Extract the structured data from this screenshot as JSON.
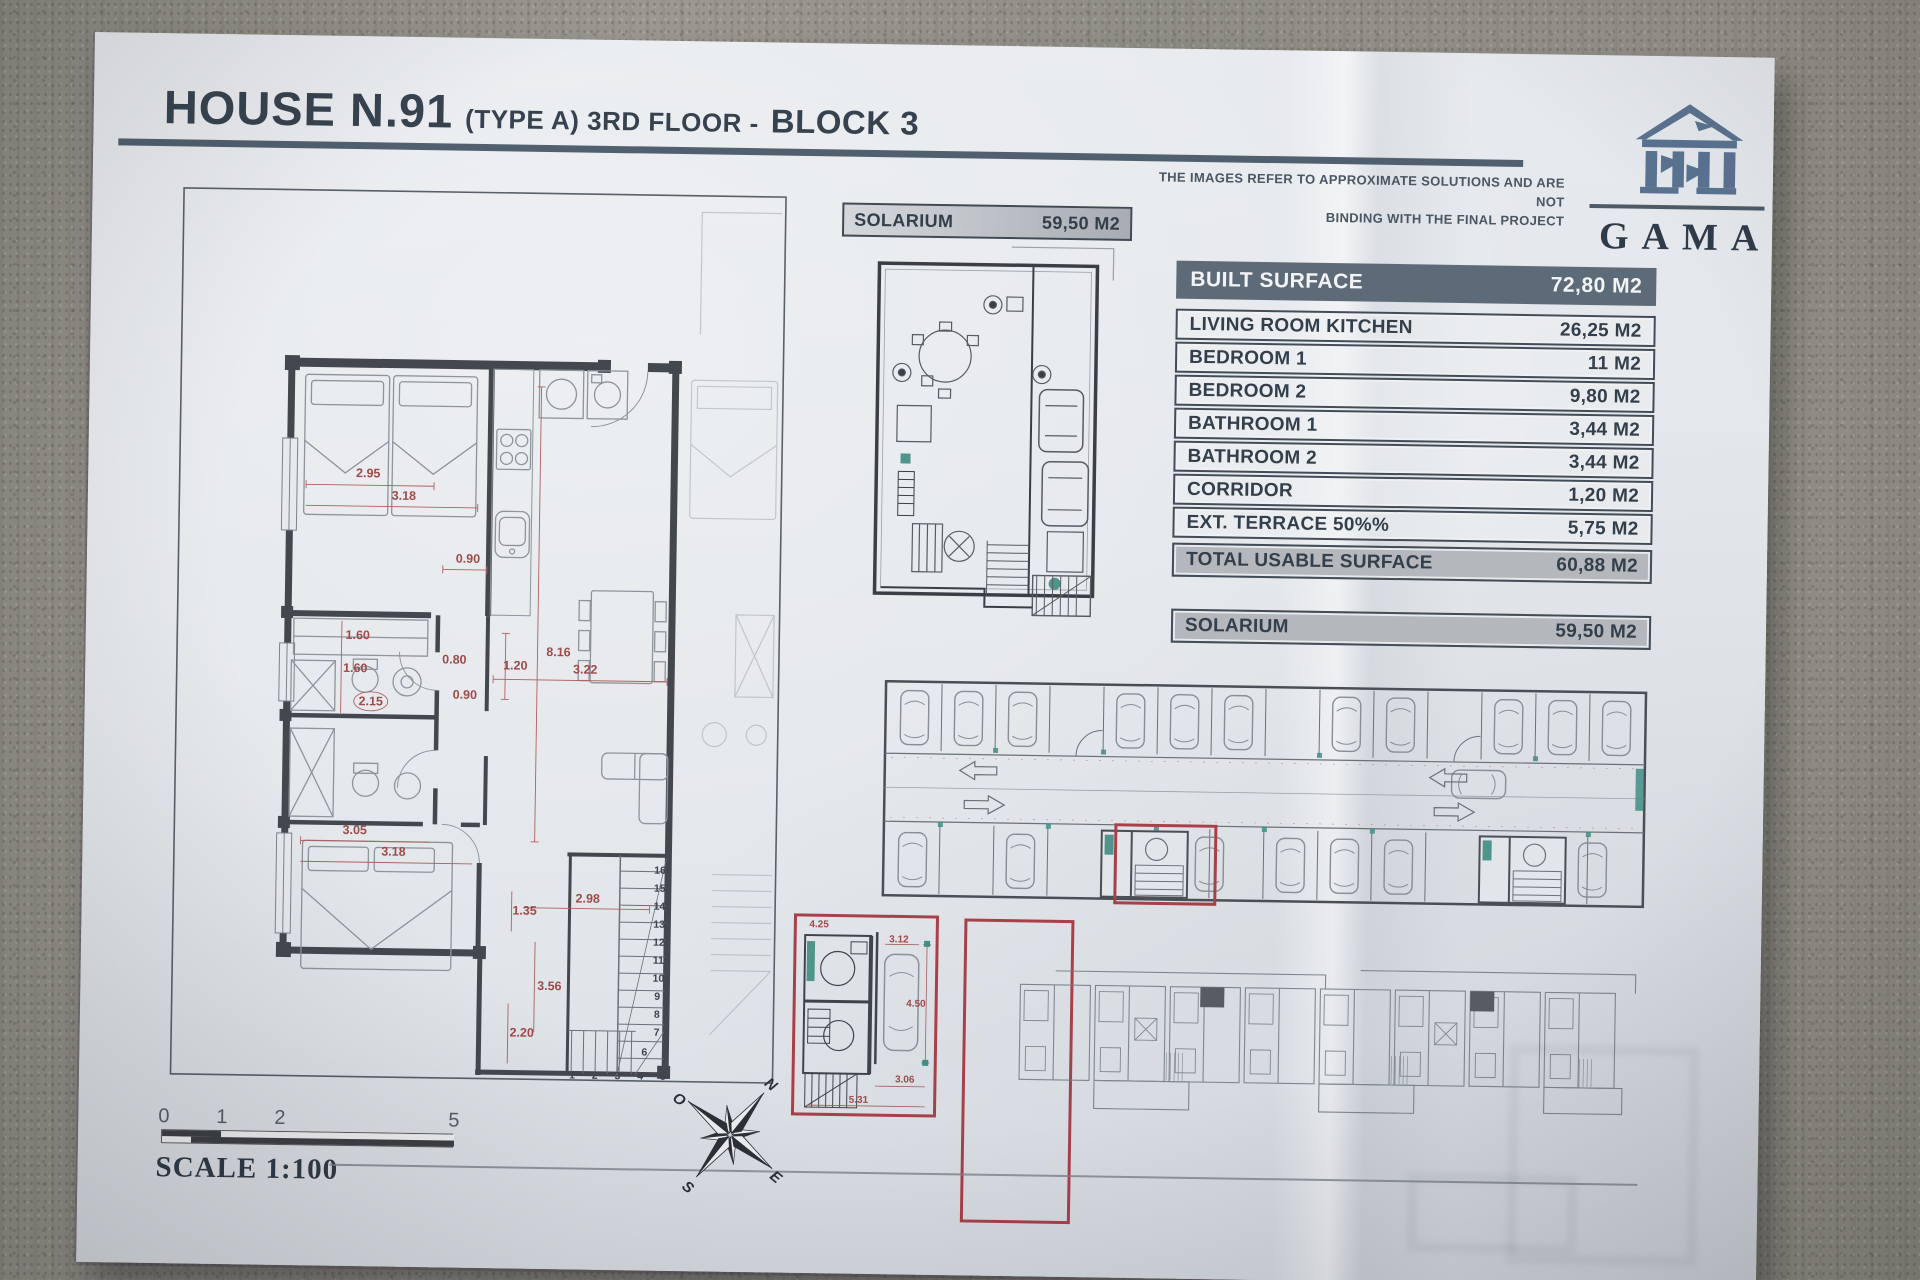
{
  "title": {
    "house": "HOUSE N.91",
    "type_floor": "(TYPE A) 3RD FLOOR -",
    "block": "BLOCK 3"
  },
  "disclaimer": {
    "line1": "THE IMAGES REFER TO APPROXIMATE SOLUTIONS AND ARE NOT",
    "line2": "BINDING WITH THE FINAL PROJECT"
  },
  "logo": {
    "name": "GAMA"
  },
  "surface_table": {
    "header": {
      "label": "BUILT SURFACE",
      "value": "72,80 M2"
    },
    "rows": [
      {
        "label": "LIVING ROOM KITCHEN",
        "value": "26,25 M2"
      },
      {
        "label": "BEDROOM 1",
        "value": "11 M2"
      },
      {
        "label": "BEDROOM 2",
        "value": "9,80 M2"
      },
      {
        "label": "BATHROOM 1",
        "value": "3,44 M2"
      },
      {
        "label": "BATHROOM 2",
        "value": "3,44 M2"
      },
      {
        "label": "CORRIDOR",
        "value": "1,20 M2"
      },
      {
        "label": "EXT. TERRACE 50%%",
        "value": "5,75 M2"
      }
    ],
    "total": {
      "label": "TOTAL USABLE SURFACE",
      "value": "60,88 M2"
    },
    "solarium": {
      "label": "SOLARIUM",
      "value": "59,50 M2"
    }
  },
  "solarium_plan": {
    "label": "SOLARIUM",
    "value": "59,50 M2"
  },
  "main_plan": {
    "dims": [
      "2.95",
      "3.18",
      "0.90",
      "8.16",
      "1.20",
      "1.60",
      "1.60",
      "2.15",
      "0.80",
      "0.90",
      "3.22",
      "3.05",
      "3.18",
      "2.98",
      "1.35",
      "3.56",
      "2.20"
    ],
    "stair_col": [
      "16",
      "15",
      "14",
      "13",
      "12",
      "11",
      "10",
      "9",
      "8",
      "7",
      "6"
    ],
    "stair_bottom": "1 2 3 4 5"
  },
  "parking_detail": {
    "dims": [
      "4.25",
      "3.12",
      "4.50",
      "3.06",
      "5.31"
    ]
  },
  "scale": {
    "label": "SCALE 1:100",
    "ticks": [
      "0",
      "1",
      "2",
      "5"
    ]
  },
  "compass": {
    "n": "N",
    "e": "E",
    "s": "S",
    "o": "O"
  },
  "colors": {
    "accent_red": "#a8404a",
    "dim_red": "#9e4a4a",
    "slate": "#46525f",
    "table_header_bg": "#5d6b79",
    "row_gray": "#b4b8bc",
    "teal": "#3f8f85",
    "logo_blue": "#5a7391"
  }
}
